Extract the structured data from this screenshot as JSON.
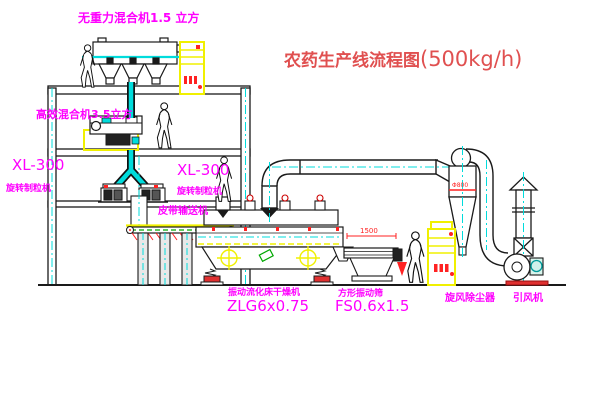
{
  "title": {
    "text": "农药生产线流程图",
    "capacity": "(500kg/h)"
  },
  "labels": {
    "top_mixer": "无重力混合机1.5 立方",
    "high_mixer": "高效混合机3.5立方",
    "granulator_left_model": "XL-300",
    "granulator_left_name": "旋转制粒机",
    "granulator_mid_model": "XL-300",
    "granulator_mid_name": "旋转制粒机",
    "belt_conveyor": "皮带输送机",
    "dryer_name": "振动流化床干燥机",
    "dryer_model": "ZLG6x0.75",
    "screen_name": "方形振动筛",
    "screen_model": "FS0.6x1.5",
    "cyclone": "旋风除尘器",
    "fan": "引风机"
  },
  "dimensions": {
    "screen_length": "1500",
    "cyclone_diameter": "Φ800"
  },
  "colors": {
    "label_magenta": "#ff00ff",
    "title_red": "#e05050",
    "dimension_red": "#ff2222",
    "pipe_cyan": "#00dcdc",
    "cabinet_yellow": "#f0f000",
    "conveyor_green": "#00a800",
    "line_black": "#1a1a1a"
  }
}
